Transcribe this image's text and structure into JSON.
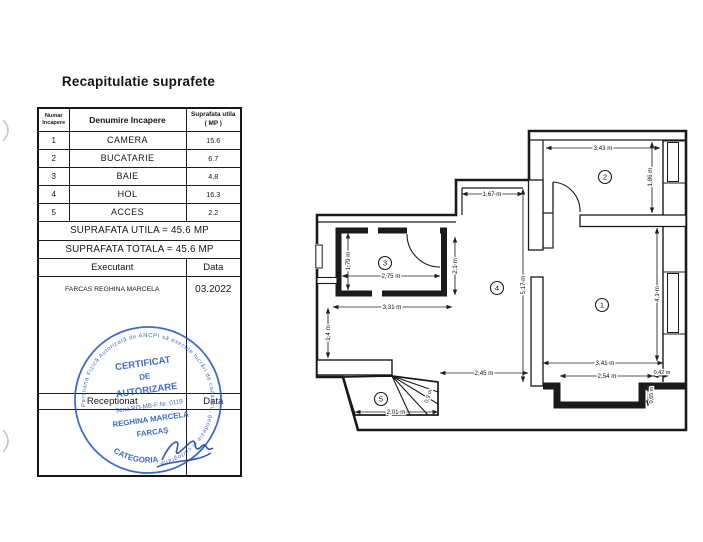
{
  "doc": {
    "title": "Recapitulatie suprafete"
  },
  "table": {
    "header": {
      "col_num_l1": "Numar",
      "col_num_l2": "Incapere",
      "col_name": "Denumire Incapere",
      "col_area_l1": "Suprafata utila",
      "col_area_l2": "( MP )"
    },
    "rows": [
      {
        "num": "1",
        "name": "CAMERA",
        "area": "15.6"
      },
      {
        "num": "2",
        "name": "BUCATARIE",
        "area": "6.7"
      },
      {
        "num": "3",
        "name": "BAIE",
        "area": "4.8"
      },
      {
        "num": "4",
        "name": "HOL",
        "area": "16.3"
      },
      {
        "num": "5",
        "name": "ACCES",
        "area": "2.2"
      }
    ],
    "total_utila": "SUPRAFATA UTILA = 45.6 MP",
    "total_totala": "SUPRAFATA TOTALA = 45.6 MP",
    "executant_label": "Executant",
    "executant_data_label": "Data",
    "executant_name": "FARCAS REGHINA MARCELA",
    "executant_date": "03.2022",
    "receptionat_label": "Receptionat",
    "receptionat_data_label": "Data"
  },
  "stamp": {
    "ring_text": "Persoana Fizică Autorizată de ANCPI să execute lucrări de cadastru, geodezie și cartografie",
    "line1": "CERTIFICAT",
    "line2": "DE",
    "line3": "AUTORIZARE",
    "line4": "Seria RO-MB-F Nr. 0119",
    "line5": "REGHINA MARCELA",
    "line6": "FARCAȘ",
    "bottom_text": "CATEGORIA",
    "color": "#2e5fc4"
  },
  "plan": {
    "rooms": [
      "1",
      "2",
      "3",
      "4",
      "5"
    ],
    "dims": {
      "d_343": "3,43 m",
      "d_186": "1,86 m",
      "d_167": "1,67 m",
      "d_179": "1,79 m",
      "d_275": "2,75 m",
      "d_21": "2,1 m",
      "d_517": "5,17 m",
      "d_331": "3,31 m",
      "d_14": "1,4 m",
      "d_245": "2,45 m",
      "d_201": "2,01 m",
      "d_09": "0,9 m",
      "d_341": "3,41 m",
      "d_254": "2,54 m",
      "d_042": "0,42 m",
      "d_065": "0,65 m",
      "d_41": "4,1 m"
    }
  }
}
